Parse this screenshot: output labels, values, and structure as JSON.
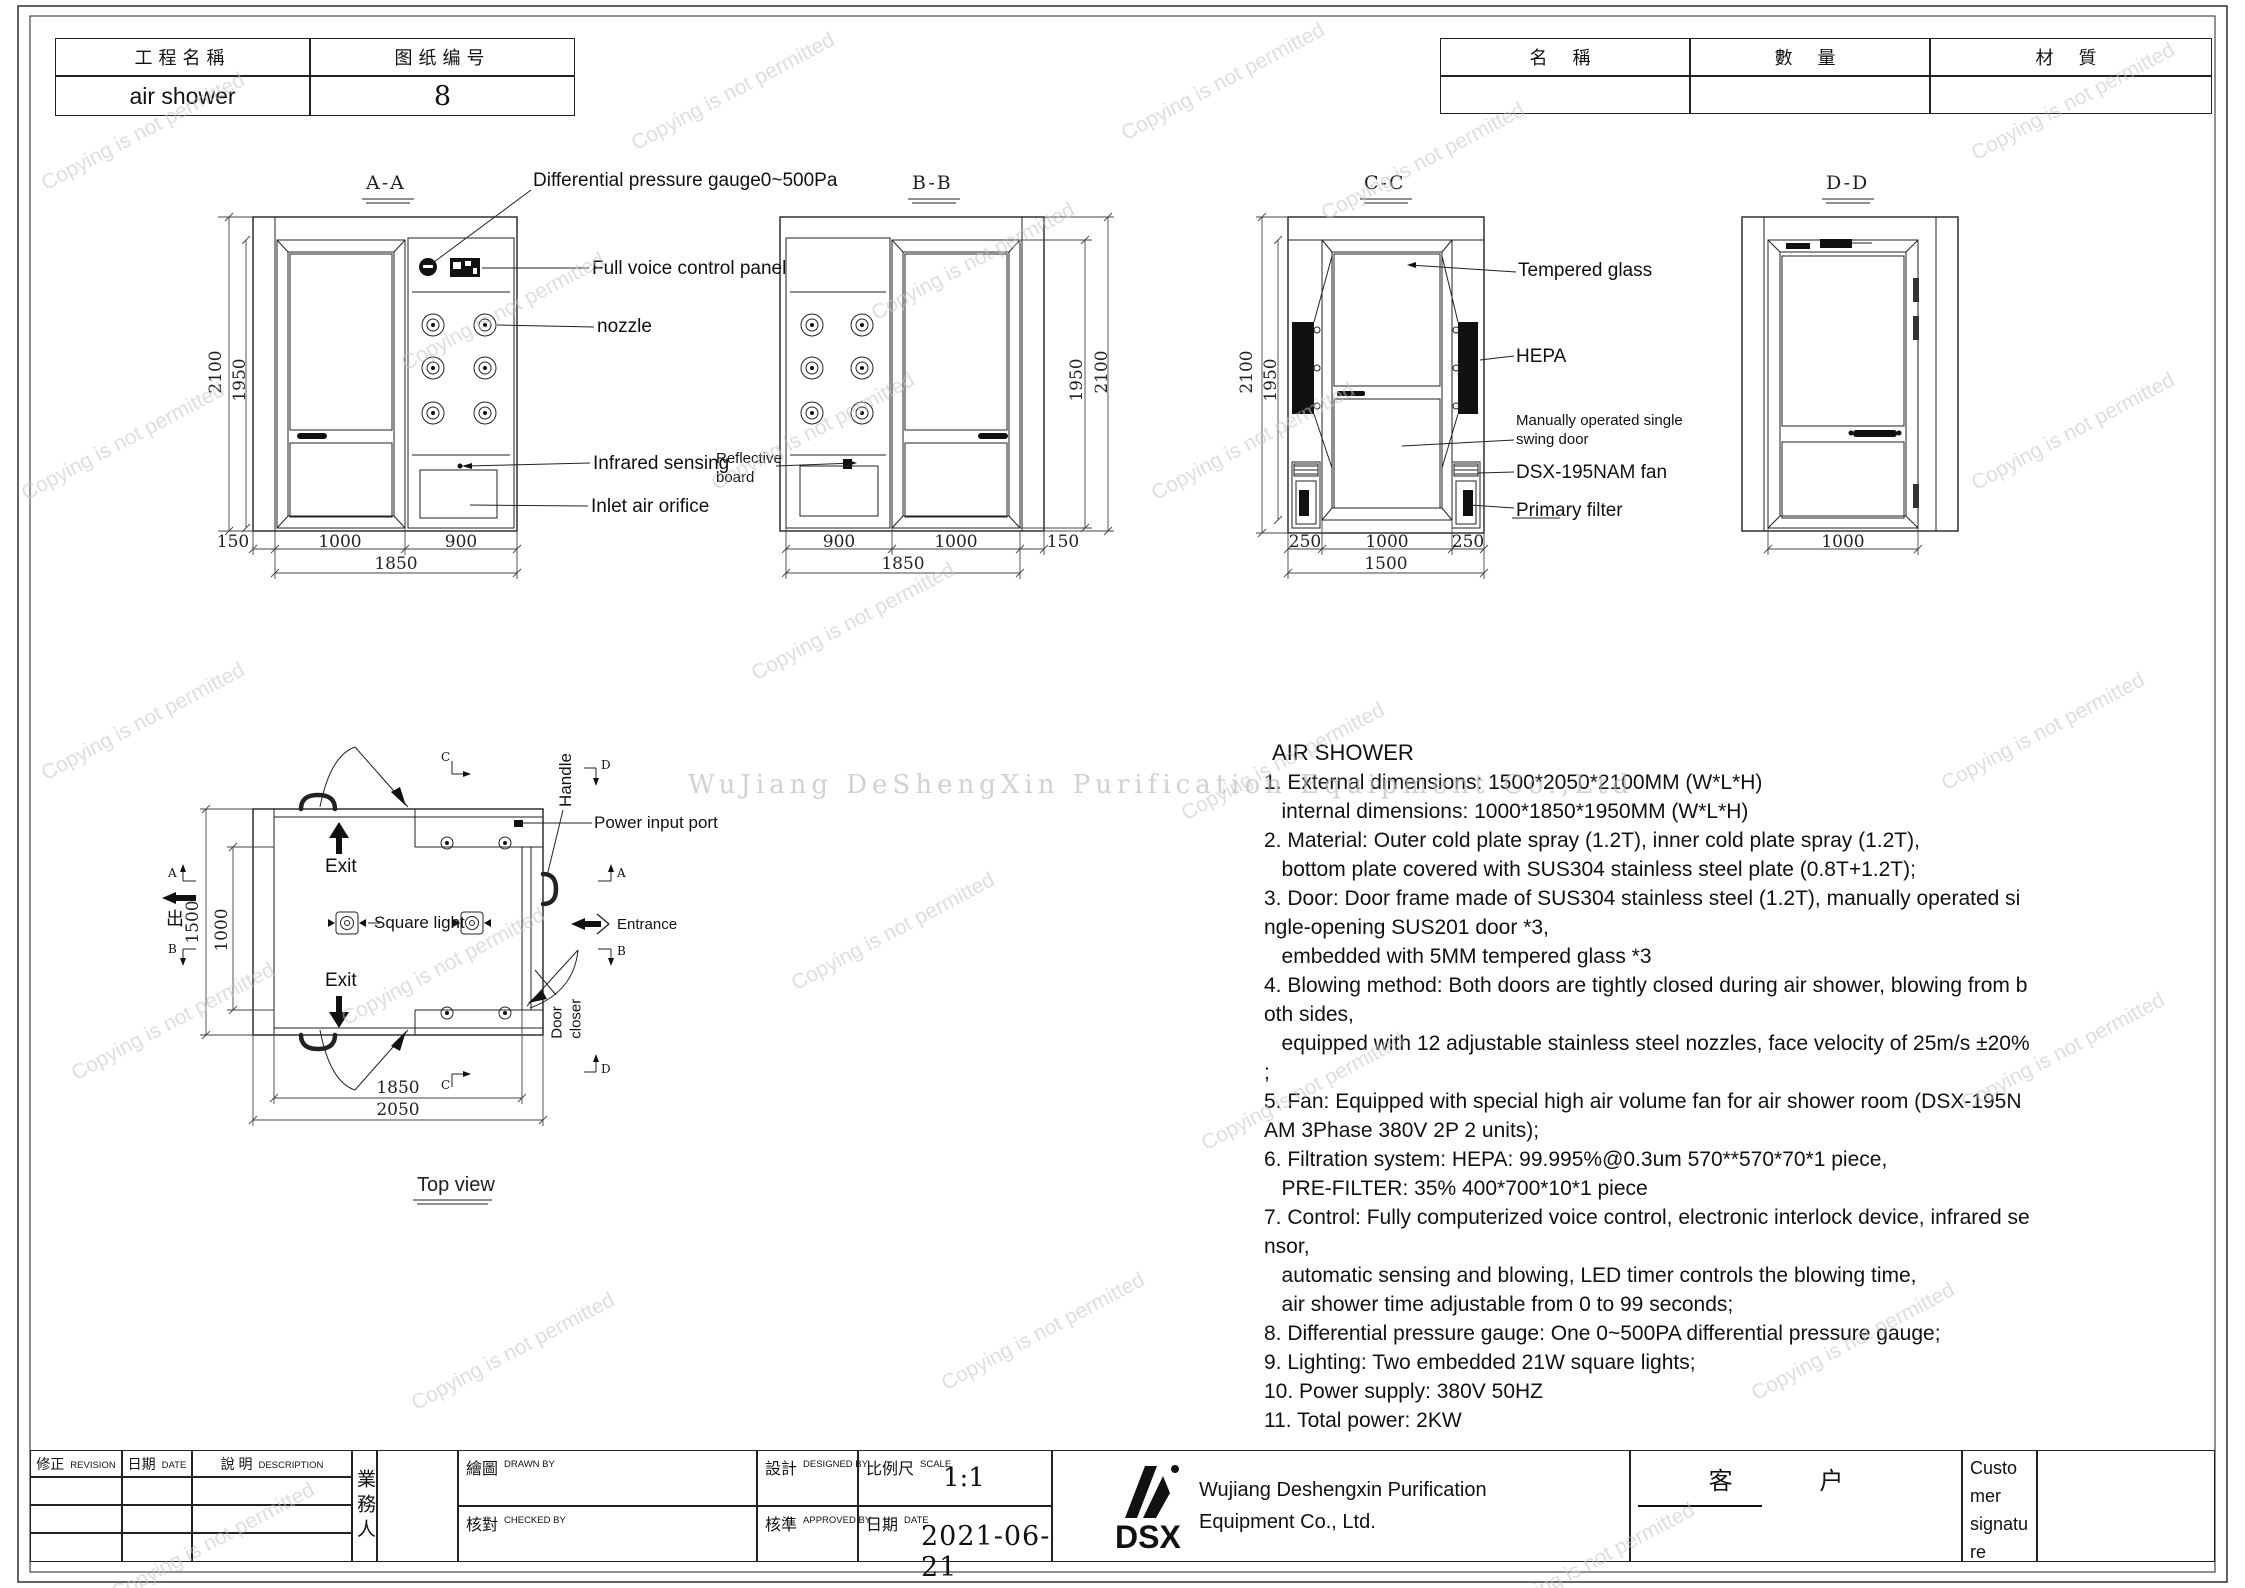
{
  "sheet": {
    "title_block": {
      "project_label": "工程名稱",
      "project_value": "air shower",
      "drawing_label": "图纸编号",
      "drawing_value": "8"
    },
    "parts_table": {
      "col_name": "名 稱",
      "col_qty": "數 量",
      "col_material": "材 質"
    }
  },
  "views": {
    "aa": {
      "title": "A-A"
    },
    "bb": {
      "title": "B-B"
    },
    "cc": {
      "title": "C-C"
    },
    "dd": {
      "title": "D-D"
    },
    "top": {
      "title": "Top view"
    }
  },
  "labels": {
    "gauge": "Differential pressure gauge0~500Pa",
    "voice_panel": "Full voice control panel",
    "nozzle": "nozzle",
    "infrared": "Infrared sensing",
    "inlet": "Inlet air orifice",
    "reflective": "Reflective\nboard",
    "tempered": "Tempered glass",
    "hepa": "HEPA",
    "swing_door": "Manually operated single\nswing door",
    "fan": "DSX-195NAM fan",
    "primary_filter": "Primary filter",
    "handle": "Handle",
    "power": "Power input port",
    "exit": "Exit",
    "exit_cn": "出",
    "entrance": "Entrance",
    "square_light": "Square light",
    "door_closer": "Door\ncloser"
  },
  "markers": {
    "a": "A",
    "b": "B",
    "c": "C",
    "d": "D"
  },
  "dims": {
    "d2100": "2100",
    "d1950": "1950",
    "d150": "150",
    "d1000": "1000",
    "d900": "900",
    "d1850": "1850",
    "d250": "250",
    "d1500": "1500",
    "d2050": "2050"
  },
  "spec": {
    "title": "AIR SHOWER",
    "body": "1. External dimensions: 1500*2050*2100MM (W*L*H)\n   internal dimensions: 1000*1850*1950MM (W*L*H)\n2. Material: Outer cold plate spray (1.2T), inner cold plate spray (1.2T),\n   bottom plate covered with SUS304 stainless steel plate (0.8T+1.2T);\n3. Door: Door frame made of SUS304 stainless steel (1.2T), manually operated si\nngle-opening SUS201 door *3,\n   embedded with 5MM tempered glass *3\n4. Blowing method: Both doors are tightly closed during air shower, blowing from b\noth sides,\n   equipped with 12 adjustable stainless steel nozzles, face velocity of 25m/s ±20%\n;\n5. Fan: Equipped with special high air volume fan for air shower room (DSX-195N\nAM 3Phase 380V 2P 2 units);\n6. Filtration system: HEPA: 99.995%@0.3um 570**570*70*1 piece,\n   PRE-FILTER: 35% 400*700*10*1 piece\n7. Control: Fully computerized voice control, electronic interlock device, infrared se\nnsor,\n   automatic sensing and blowing, LED timer controls the blowing time,\n   air shower time adjustable from 0 to 99 seconds;\n8. Differential pressure gauge: One 0~500PA differential pressure gauge;\n9. Lighting: Two embedded 21W square lights;\n10. Power supply: 380V 50HZ\n11. Total power: 2KW"
  },
  "footer": {
    "revision_cn": "修正",
    "revision_en": "REVISION",
    "date_cn": "日期",
    "date_en": "DATE",
    "desc_cn": "說  明",
    "desc_en": "DESCRIPTION",
    "sales": "業務人",
    "drawn_cn": "繪圖",
    "drawn_en": "DRAWN BY",
    "checked_cn": "核對",
    "checked_en": "CHECKED BY",
    "designed_cn": "設計",
    "designed_en": "DESIGNED BY",
    "approved_cn": "核準",
    "approved_en": "APPROVED BY",
    "scale_cn": "比例尺",
    "scale_en": "SCALE",
    "scale_value": "1:1",
    "date2_cn": "日期",
    "date2_en": "DATE",
    "date_value": "2021-06-21",
    "logo_text": "DSX",
    "company_line1": "Wujiang Deshengxin Purification",
    "company_line2": "Equipment Co., Ltd.",
    "customer_cn": "客  户",
    "customer_signature": "Customer signature"
  },
  "watermark": {
    "diagonal": "Copying is not permitted",
    "center": "WuJiang DeShengXin  Purification  Equipment  Co.,Ltd"
  }
}
